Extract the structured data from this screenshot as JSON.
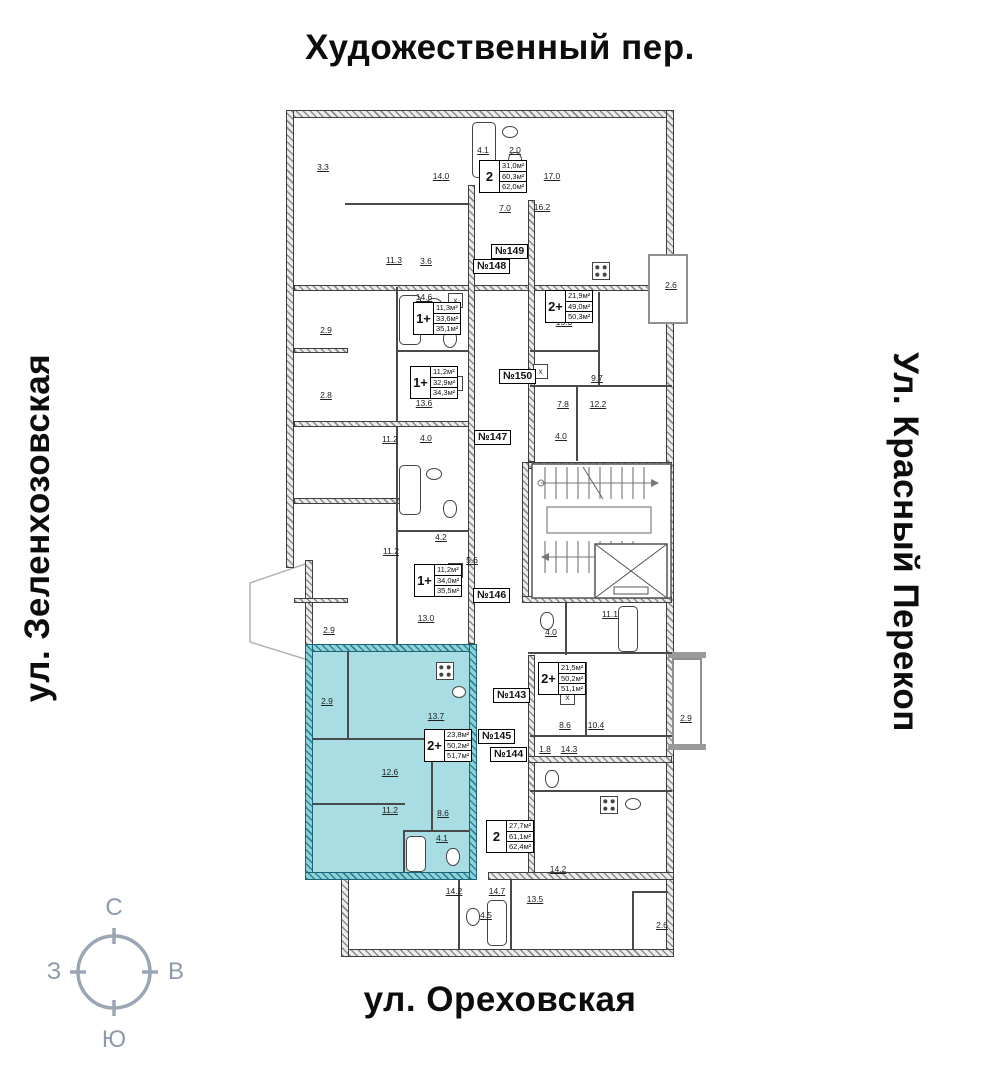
{
  "streets": {
    "top": "Художественный пер.",
    "bottom": "ул. Ореховская",
    "left": "ул. Зеленхозовская",
    "right": "Ул. Красный Перекоп"
  },
  "compass": {
    "north": "С",
    "south": "Ю",
    "west": "З",
    "east": "В"
  },
  "highlight_color": "#a9dde4",
  "plan": {
    "wardrobe_char": "х",
    "units": [
      {
        "type": "2",
        "areas": [
          "31,0м²",
          "60,3м²",
          "62,0м²"
        ],
        "x": 479,
        "y": 160,
        "highlighted": false
      },
      {
        "type": "2+",
        "areas": [
          "21,9м²",
          "49,0м²",
          "50,3м²"
        ],
        "x": 545,
        "y": 290,
        "highlighted": false
      },
      {
        "type": "1+",
        "areas": [
          "11,3м²",
          "33,6м²",
          "35,1м²"
        ],
        "x": 413,
        "y": 302,
        "highlighted": false
      },
      {
        "type": "1+",
        "areas": [
          "11,2м²",
          "32,9м²",
          "34,3м²"
        ],
        "x": 410,
        "y": 366,
        "highlighted": false
      },
      {
        "type": "1+",
        "areas": [
          "11,2м²",
          "34,0м²",
          "35,5м²"
        ],
        "x": 414,
        "y": 564,
        "highlighted": false
      },
      {
        "type": "2+",
        "areas": [
          "21,5м²",
          "50,2м²",
          "51,1м²"
        ],
        "x": 538,
        "y": 662,
        "highlighted": false
      },
      {
        "type": "2+",
        "areas": [
          "23,8м²",
          "50,2м²",
          "51,7м²"
        ],
        "x": 424,
        "y": 729,
        "highlighted": true
      },
      {
        "type": "2",
        "areas": [
          "27,7м²",
          "61,1м²",
          "62,4м²"
        ],
        "x": 486,
        "y": 820,
        "highlighted": false
      }
    ],
    "unit_numbers": [
      {
        "label": "№149",
        "x": 491,
        "y": 244
      },
      {
        "label": "№148",
        "x": 473,
        "y": 259
      },
      {
        "label": "№150",
        "x": 499,
        "y": 369
      },
      {
        "label": "№147",
        "x": 474,
        "y": 430
      },
      {
        "label": "№146",
        "x": 473,
        "y": 588
      },
      {
        "label": "№143",
        "x": 493,
        "y": 688
      },
      {
        "label": "№145",
        "x": 478,
        "y": 729
      },
      {
        "label": "№144",
        "x": 490,
        "y": 747
      }
    ],
    "dimensions": [
      {
        "x": 323,
        "y": 167,
        "t": "3.3"
      },
      {
        "x": 441,
        "y": 176,
        "t": "14.0"
      },
      {
        "x": 483,
        "y": 150,
        "t": "4.1"
      },
      {
        "x": 515,
        "y": 150,
        "t": "2.0"
      },
      {
        "x": 552,
        "y": 176,
        "t": "17.0"
      },
      {
        "x": 505,
        "y": 208,
        "t": "7.0"
      },
      {
        "x": 542,
        "y": 207,
        "t": "16.2"
      },
      {
        "x": 394,
        "y": 260,
        "t": "11.3"
      },
      {
        "x": 426,
        "y": 261,
        "t": "3.6"
      },
      {
        "x": 424,
        "y": 297,
        "t": "14.6"
      },
      {
        "x": 671,
        "y": 285,
        "t": "2.6"
      },
      {
        "x": 564,
        "y": 322,
        "t": "15.3"
      },
      {
        "x": 326,
        "y": 330,
        "t": "2.9"
      },
      {
        "x": 326,
        "y": 395,
        "t": "2.8"
      },
      {
        "x": 597,
        "y": 378,
        "t": "9.7"
      },
      {
        "x": 424,
        "y": 403,
        "t": "13.6"
      },
      {
        "x": 563,
        "y": 404,
        "t": "7.8"
      },
      {
        "x": 598,
        "y": 404,
        "t": "12.2"
      },
      {
        "x": 390,
        "y": 439,
        "t": "11.2"
      },
      {
        "x": 426,
        "y": 438,
        "t": "4.0"
      },
      {
        "x": 561,
        "y": 436,
        "t": "4.0"
      },
      {
        "x": 391,
        "y": 551,
        "t": "11.2"
      },
      {
        "x": 441,
        "y": 537,
        "t": "4.2"
      },
      {
        "x": 472,
        "y": 560,
        "t": "5.6"
      },
      {
        "x": 426,
        "y": 618,
        "t": "13.0"
      },
      {
        "x": 329,
        "y": 630,
        "t": "2.9"
      },
      {
        "x": 610,
        "y": 614,
        "t": "11.1"
      },
      {
        "x": 551,
        "y": 632,
        "t": "4.0"
      },
      {
        "x": 327,
        "y": 701,
        "t": "2.9"
      },
      {
        "x": 436,
        "y": 716,
        "t": "13.7"
      },
      {
        "x": 390,
        "y": 772,
        "t": "12.6"
      },
      {
        "x": 390,
        "y": 810,
        "t": "11.2"
      },
      {
        "x": 443,
        "y": 813,
        "t": "8.6"
      },
      {
        "x": 442,
        "y": 838,
        "t": "4.1"
      },
      {
        "x": 565,
        "y": 725,
        "t": "8.6"
      },
      {
        "x": 596,
        "y": 725,
        "t": "10.4"
      },
      {
        "x": 545,
        "y": 749,
        "t": "1.8"
      },
      {
        "x": 569,
        "y": 749,
        "t": "14.3"
      },
      {
        "x": 686,
        "y": 718,
        "t": "2.9"
      },
      {
        "x": 558,
        "y": 869,
        "t": "14.2"
      },
      {
        "x": 454,
        "y": 891,
        "t": "14.2"
      },
      {
        "x": 497,
        "y": 891,
        "t": "14.7"
      },
      {
        "x": 486,
        "y": 915,
        "t": "4.5"
      },
      {
        "x": 535,
        "y": 899,
        "t": "13.5"
      },
      {
        "x": 662,
        "y": 925,
        "t": "2.6"
      }
    ],
    "fixtures": [
      {
        "type": "tub",
        "x": 472,
        "y": 122,
        "w": 24,
        "h": 56
      },
      {
        "type": "sink",
        "x": 502,
        "y": 126,
        "w": 16,
        "h": 12
      },
      {
        "type": "toilet",
        "x": 508,
        "y": 152,
        "w": 14,
        "h": 18
      },
      {
        "type": "tub",
        "x": 399,
        "y": 295,
        "w": 22,
        "h": 50
      },
      {
        "type": "sink",
        "x": 426,
        "y": 298,
        "w": 16,
        "h": 12
      },
      {
        "type": "toilet",
        "x": 443,
        "y": 330,
        "w": 14,
        "h": 18
      },
      {
        "type": "tub",
        "x": 399,
        "y": 465,
        "w": 22,
        "h": 50
      },
      {
        "type": "sink",
        "x": 426,
        "y": 468,
        "w": 16,
        "h": 12
      },
      {
        "type": "toilet",
        "x": 443,
        "y": 500,
        "w": 14,
        "h": 18
      },
      {
        "type": "stove",
        "x": 592,
        "y": 262,
        "w": 18,
        "h": 18
      },
      {
        "type": "tub",
        "x": 618,
        "y": 606,
        "w": 20,
        "h": 46
      },
      {
        "type": "toilet",
        "x": 540,
        "y": 612,
        "w": 14,
        "h": 18
      },
      {
        "type": "stove",
        "x": 436,
        "y": 662,
        "w": 18,
        "h": 18
      },
      {
        "type": "sink",
        "x": 452,
        "y": 686,
        "w": 14,
        "h": 12
      },
      {
        "type": "tub",
        "x": 406,
        "y": 836,
        "w": 20,
        "h": 36
      },
      {
        "type": "toilet",
        "x": 446,
        "y": 848,
        "w": 14,
        "h": 18
      },
      {
        "type": "stove",
        "x": 600,
        "y": 796,
        "w": 18,
        "h": 18
      },
      {
        "type": "sink",
        "x": 625,
        "y": 798,
        "w": 16,
        "h": 12
      },
      {
        "type": "toilet",
        "x": 545,
        "y": 770,
        "w": 14,
        "h": 18
      },
      {
        "type": "tub",
        "x": 487,
        "y": 900,
        "w": 20,
        "h": 46
      },
      {
        "type": "toilet",
        "x": 466,
        "y": 908,
        "w": 14,
        "h": 18
      },
      {
        "type": "wardrobe",
        "x": 448,
        "y": 293,
        "w": 15,
        "h": 15
      },
      {
        "type": "wardrobe",
        "x": 448,
        "y": 376,
        "w": 15,
        "h": 15
      },
      {
        "type": "wardrobe",
        "x": 448,
        "y": 563,
        "w": 15,
        "h": 15
      },
      {
        "type": "wardrobe",
        "x": 533,
        "y": 364,
        "w": 15,
        "h": 15
      },
      {
        "type": "wardrobe",
        "x": 560,
        "y": 690,
        "w": 15,
        "h": 15
      }
    ]
  }
}
